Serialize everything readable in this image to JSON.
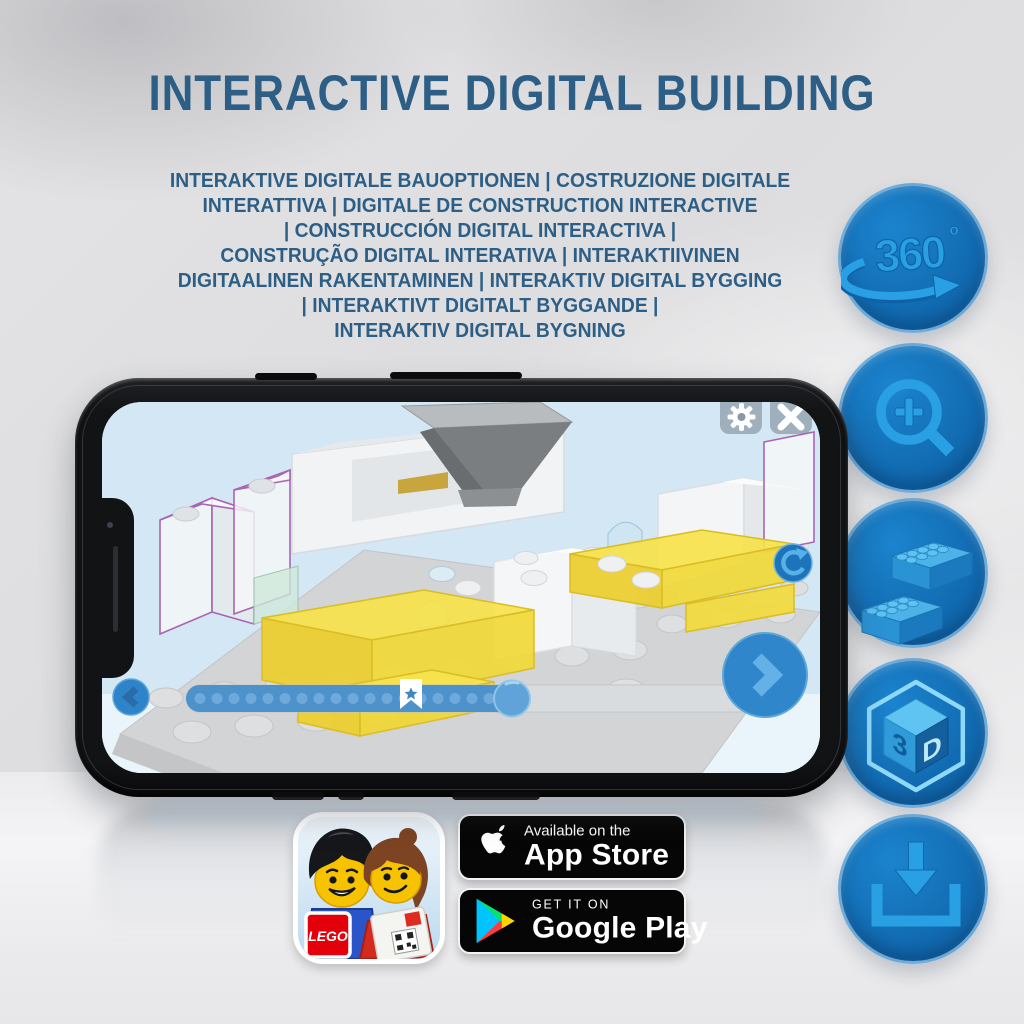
{
  "title": "INTERACTIVE DIGITAL BUILDING",
  "subtitle_lines": [
    "INTERAKTIVE DIGITALE BAUOPTIONEN | COSTRUZIONE DIGITALE",
    "INTERATTIVA | DIGITALE DE CONSTRUCTION INTERACTIVE",
    "| CONSTRUCCIÓN DIGITAL INTERACTIVA |",
    "CONSTRUÇÃO DIGITAL INTERATIVA | INTERAKTIIVINEN",
    "DIGITAALINEN RAKENTAMINEN | INTERAKTIV DIGITAL BYGGING",
    "| INTERAKTIVT DIGITALT BYGGANDE |",
    "INTERAKTIV DIGITAL BYGNING"
  ],
  "features": [
    {
      "name": "360-rotation",
      "text": "360",
      "sup": "º"
    },
    {
      "name": "zoom-in"
    },
    {
      "name": "lego-bricks"
    },
    {
      "name": "3d-view",
      "left": "3",
      "right": "D"
    },
    {
      "name": "download"
    }
  ],
  "badges": {
    "lego_app": {
      "logo": "LEGO"
    },
    "app_store": {
      "line1": "Available on the",
      "line2": "App Store"
    },
    "google_play": {
      "line1": "GET IT ON",
      "line2": "Google Play"
    }
  },
  "colors": {
    "title_blue": "#2d5f86",
    "circle_blue": "#1168ae",
    "icon_blue": "#2aa0e4",
    "brick_yellow": "#f2d93c",
    "screen_sky": "#d3e7f5"
  }
}
